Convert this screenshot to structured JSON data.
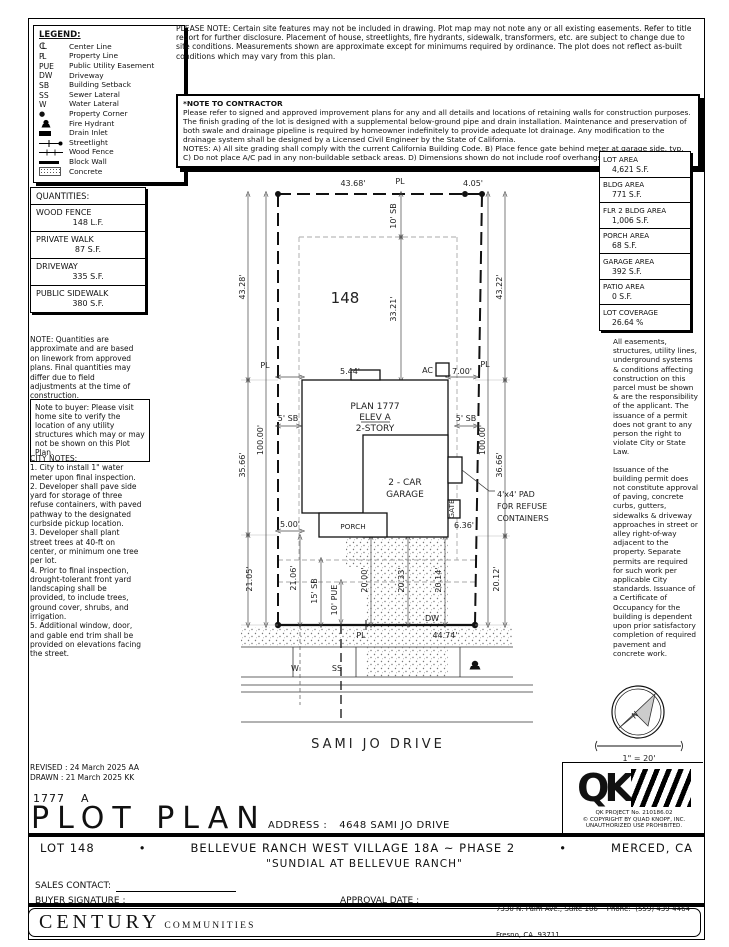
{
  "legend": {
    "title": "LEGEND:",
    "items": [
      {
        "sym": "CL",
        "label": "Center Line"
      },
      {
        "sym": "PL",
        "label": "Property Line"
      },
      {
        "sym": "PUE",
        "label": "Public Utility Easement"
      },
      {
        "sym": "DW",
        "label": "Driveway"
      },
      {
        "sym": "SB",
        "label": "Building Setback"
      },
      {
        "sym": "SS",
        "label": "Sewer Lateral"
      },
      {
        "sym": "W",
        "label": "Water Lateral"
      },
      {
        "sym": "●",
        "label": "Property Corner"
      },
      {
        "sym": "",
        "label": "Fire Hydrant"
      },
      {
        "sym": "",
        "label": "Drain Inlet"
      },
      {
        "sym": "",
        "label": "Streetlight"
      },
      {
        "sym": "",
        "label": "Wood Fence"
      },
      {
        "sym": "",
        "label": "Block Wall"
      },
      {
        "sym": "",
        "label": "Concrete"
      }
    ]
  },
  "top_note": "PLEASE NOTE:  Certain site features may not be included in drawing. Plot map may not note any or all existing easements. Refer to title report for further disclosure. Placement of house, streetlights, fire hydrants, sidewalk, transformers, etc. are subject to change due to site conditions. Measurements shown are approximate except for minimums required by ordinance. The plot does not reflect as-built conditions which may vary from this plan.",
  "contractor_note": {
    "title": "*NOTE TO CONTRACTOR",
    "body": "Please refer to signed and approved improvement plans for any and all details and locations of retaining walls for construction purposes. The finish grading of the lot is designed with a supplemental below-ground pipe and drain installation. Maintenance and preservation of both swale and drainage pipeline is required by homeowner indefinitely to provide adequate lot drainage. Any modification to the drainage system shall be designed by a Licensed Civil Engineer by the State of California.",
    "notes": "NOTES:  A) All site grading shall comply with the current California Building Code.  B) Place fence gate behind meter at garage side, typ.\nC) Do not place A/C pad in any non-buildable setback areas.  D) Dimensions shown do not include roof overhangs."
  },
  "area_table": [
    {
      "label": "LOT AREA",
      "value": "4,621 S.F."
    },
    {
      "label": "BLDG AREA",
      "value": "771 S.F."
    },
    {
      "label": "FLR 2 BLDG AREA",
      "value": "1,006 S.F."
    },
    {
      "label": "PORCH AREA",
      "value": "68 S.F."
    },
    {
      "label": "GARAGE AREA",
      "value": "392 S.F."
    },
    {
      "label": "PATIO AREA",
      "value": "0 S.F."
    },
    {
      "label": "LOT COVERAGE",
      "value": "26.64 %"
    }
  ],
  "right_notes": {
    "p1": "All easements, structures, utility lines, underground systems & conditions affecting construction on this parcel must be shown & are the responsibility of the applicant. The issuance of a permit does not grant to any person the right to violate City or State Law.",
    "p2": "Issuance of the building permit does not constitute approval of paving, concrete curbs, gutters, sidewalks & driveway approaches in street or alley right-of-way adjacent to the property. Separate permits are required for such work per applicable City standards. Issuance of a Certificate of Occupancy for the building is dependent upon prior satisfactory completion of required pavement and concrete work."
  },
  "quantities": {
    "title": "QUANTITIES:",
    "items": [
      {
        "label": "WOOD FENCE",
        "value": "148 L.F."
      },
      {
        "label": "PRIVATE WALK",
        "value": "87 S.F."
      },
      {
        "label": "DRIVEWAY",
        "value": "335 S.F."
      },
      {
        "label": "PUBLIC SIDEWALK",
        "value": "380 S.F."
      }
    ]
  },
  "quantities_note": "NOTE: Quantities are approximate and are based on linework from approved plans.  Final quantities may differ due to field adjustments at the time of construction.",
  "buyer_note": "Note to buyer: Please visit home site to verify the location of any utility structures which may or may not be shown on this Plot Plan.",
  "city_notes": {
    "title": "CITY NOTES:",
    "items": [
      "1. City to install 1\" water meter upon final inspection.",
      "2. Developer shall pave side yard for storage of three refuse containers, with paved pathway to the designated curbside pickup location.",
      "3. Developer shall plant street trees at 40-ft on center, or minimum one tree per lot.",
      "4. Prior to final inspection, drought-tolerant front yard landscaping shall be provided, to include trees, ground cover, shrubs, and irrigation.",
      "5. Additional window, door, and gable end trim shall be provided on elevations facing the street."
    ]
  },
  "plot": {
    "lot_number": "148",
    "pl": "PL",
    "top_width": "43.68'",
    "top_right_width": "4.05'",
    "left_rear": "43.28'",
    "left_mid": "35.66'",
    "left_front": "21.05'",
    "left_depth": "100.00'",
    "right_rear": "43.22'",
    "right_mid": "36.66'",
    "right_front": "20.12'",
    "right_depth": "100.00'",
    "rear_sb": "10' SB",
    "rear_to_house": "33.21'",
    "left_gap": "5.44'",
    "right_gap": "7.00'",
    "sb5": "5' SB",
    "porch_side": "5.00'",
    "plan": "PLAN 1777",
    "elev": "ELEV A",
    "story": "2-STORY",
    "garage_l1": "2 - CAR",
    "garage_l2": "GARAGE",
    "porch": "PORCH",
    "ac": "AC",
    "gate": "GATE",
    "gate_dim": "6.36'",
    "refuse_l1": "4'x4' PAD",
    "refuse_l2": "FOR REFUSE",
    "refuse_l3": "CONTAINERS",
    "d_2106": "21.06'",
    "d_15sb": "15' SB",
    "d_10pue": "10' PUE",
    "d_2000": "20.00'",
    "d_2033": "20.33'",
    "d_2014": "20.14'",
    "front_width": "44.74'",
    "dw": "DW",
    "w": "W",
    "ss": "SS",
    "street": "SAMI JO DRIVE"
  },
  "compass": {
    "n": "N",
    "scale": "1\" = 20'"
  },
  "revision": {
    "revised": "REVISED :  24 March 2025   AA",
    "drawn": "DRAWN :   21 March 2025   KK"
  },
  "title_block": {
    "plan_no": "1777",
    "rev": "A",
    "title": "PLOT PLAN",
    "address_label": "ADDRESS :",
    "address": "4648 SAMI JO DRIVE"
  },
  "qk": {
    "letters": "QK",
    "project": "QK PROJECT No. 210186.02",
    "copyright": "© COPYRIGHT BY QUAD KNOPF, INC.",
    "unauthorized": "UNAUTHORIZED USE PROHIBITED."
  },
  "footer": {
    "lot": "LOT 148",
    "bullet": "•",
    "subdivision": "BELLEVUE RANCH WEST VILLAGE 18A ~ PHASE 2",
    "city": "MERCED, CA",
    "community": "\"SUNDIAL AT BELLEVUE RANCH\"",
    "sales_contact_label": "SALES CONTACT:",
    "buyer_signature_label": "BUYER SIGNATURE :",
    "approval_date_label": "APPROVAL DATE :",
    "brand": "CENTURY",
    "brand2": "COMMUNITIES",
    "addr_line1": "7330 N. Palm Ave., Suite 106    Phone:  (559) 439-4464",
    "addr_line2": "Fresno, CA  93711"
  }
}
